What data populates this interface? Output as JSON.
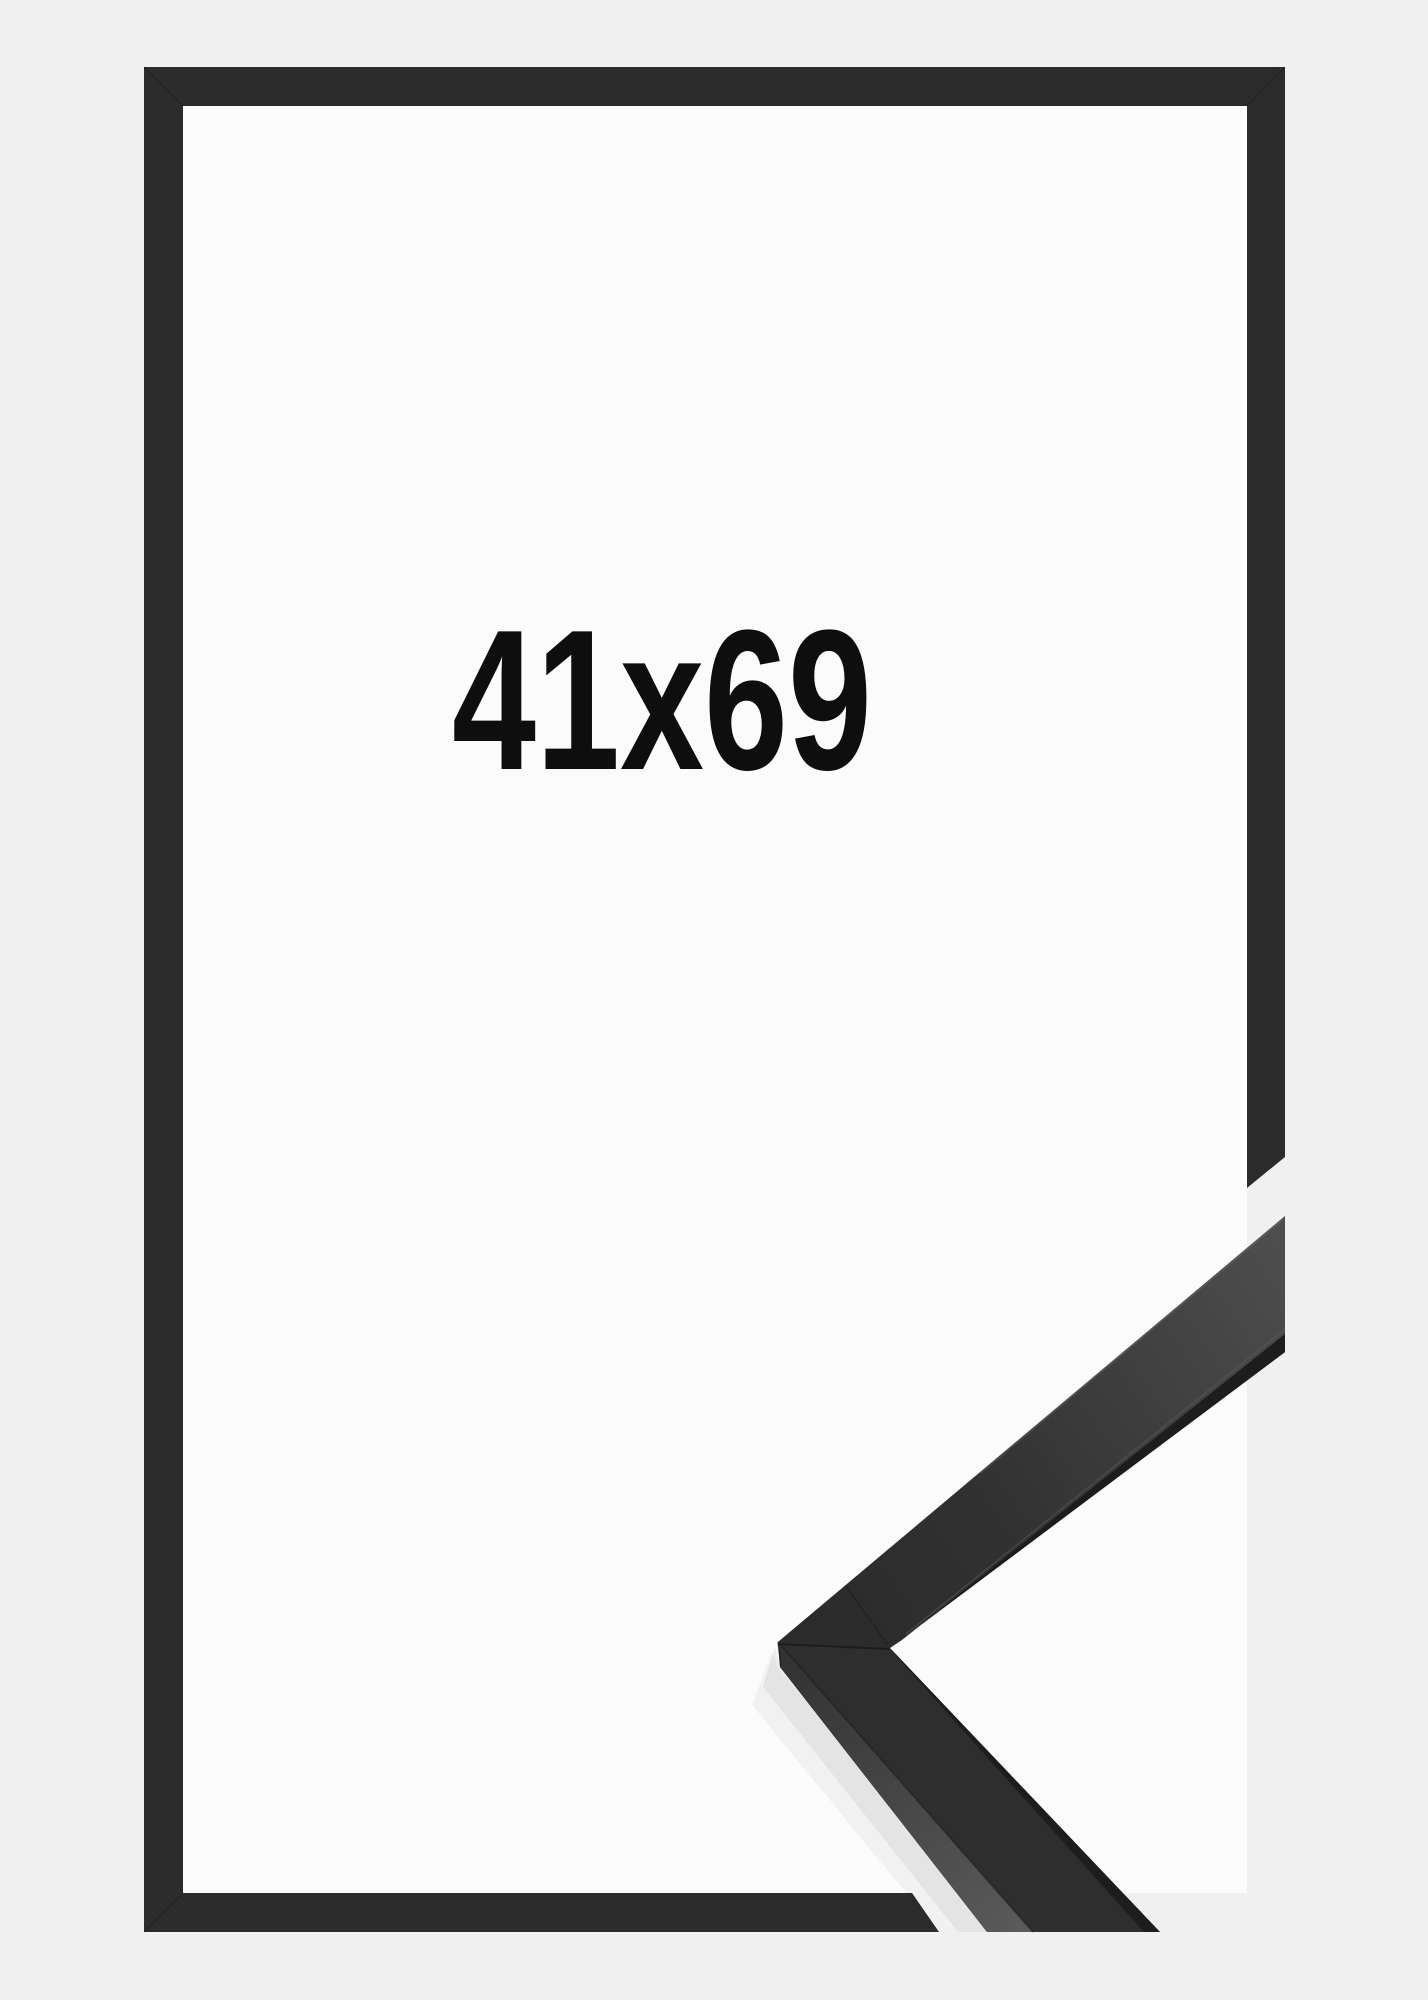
{
  "product_image": {
    "size_label": "41x69"
  },
  "colors": {
    "background": "#f0f0f0",
    "paper": "#fbfbfb",
    "frame": "#2c2c2c",
    "moulding_face": "#2e2e2e",
    "moulding_side_light": "#4e4e4e",
    "moulding_edge_dark": "#1a1a1a",
    "label_text": "#0e0e0e"
  }
}
